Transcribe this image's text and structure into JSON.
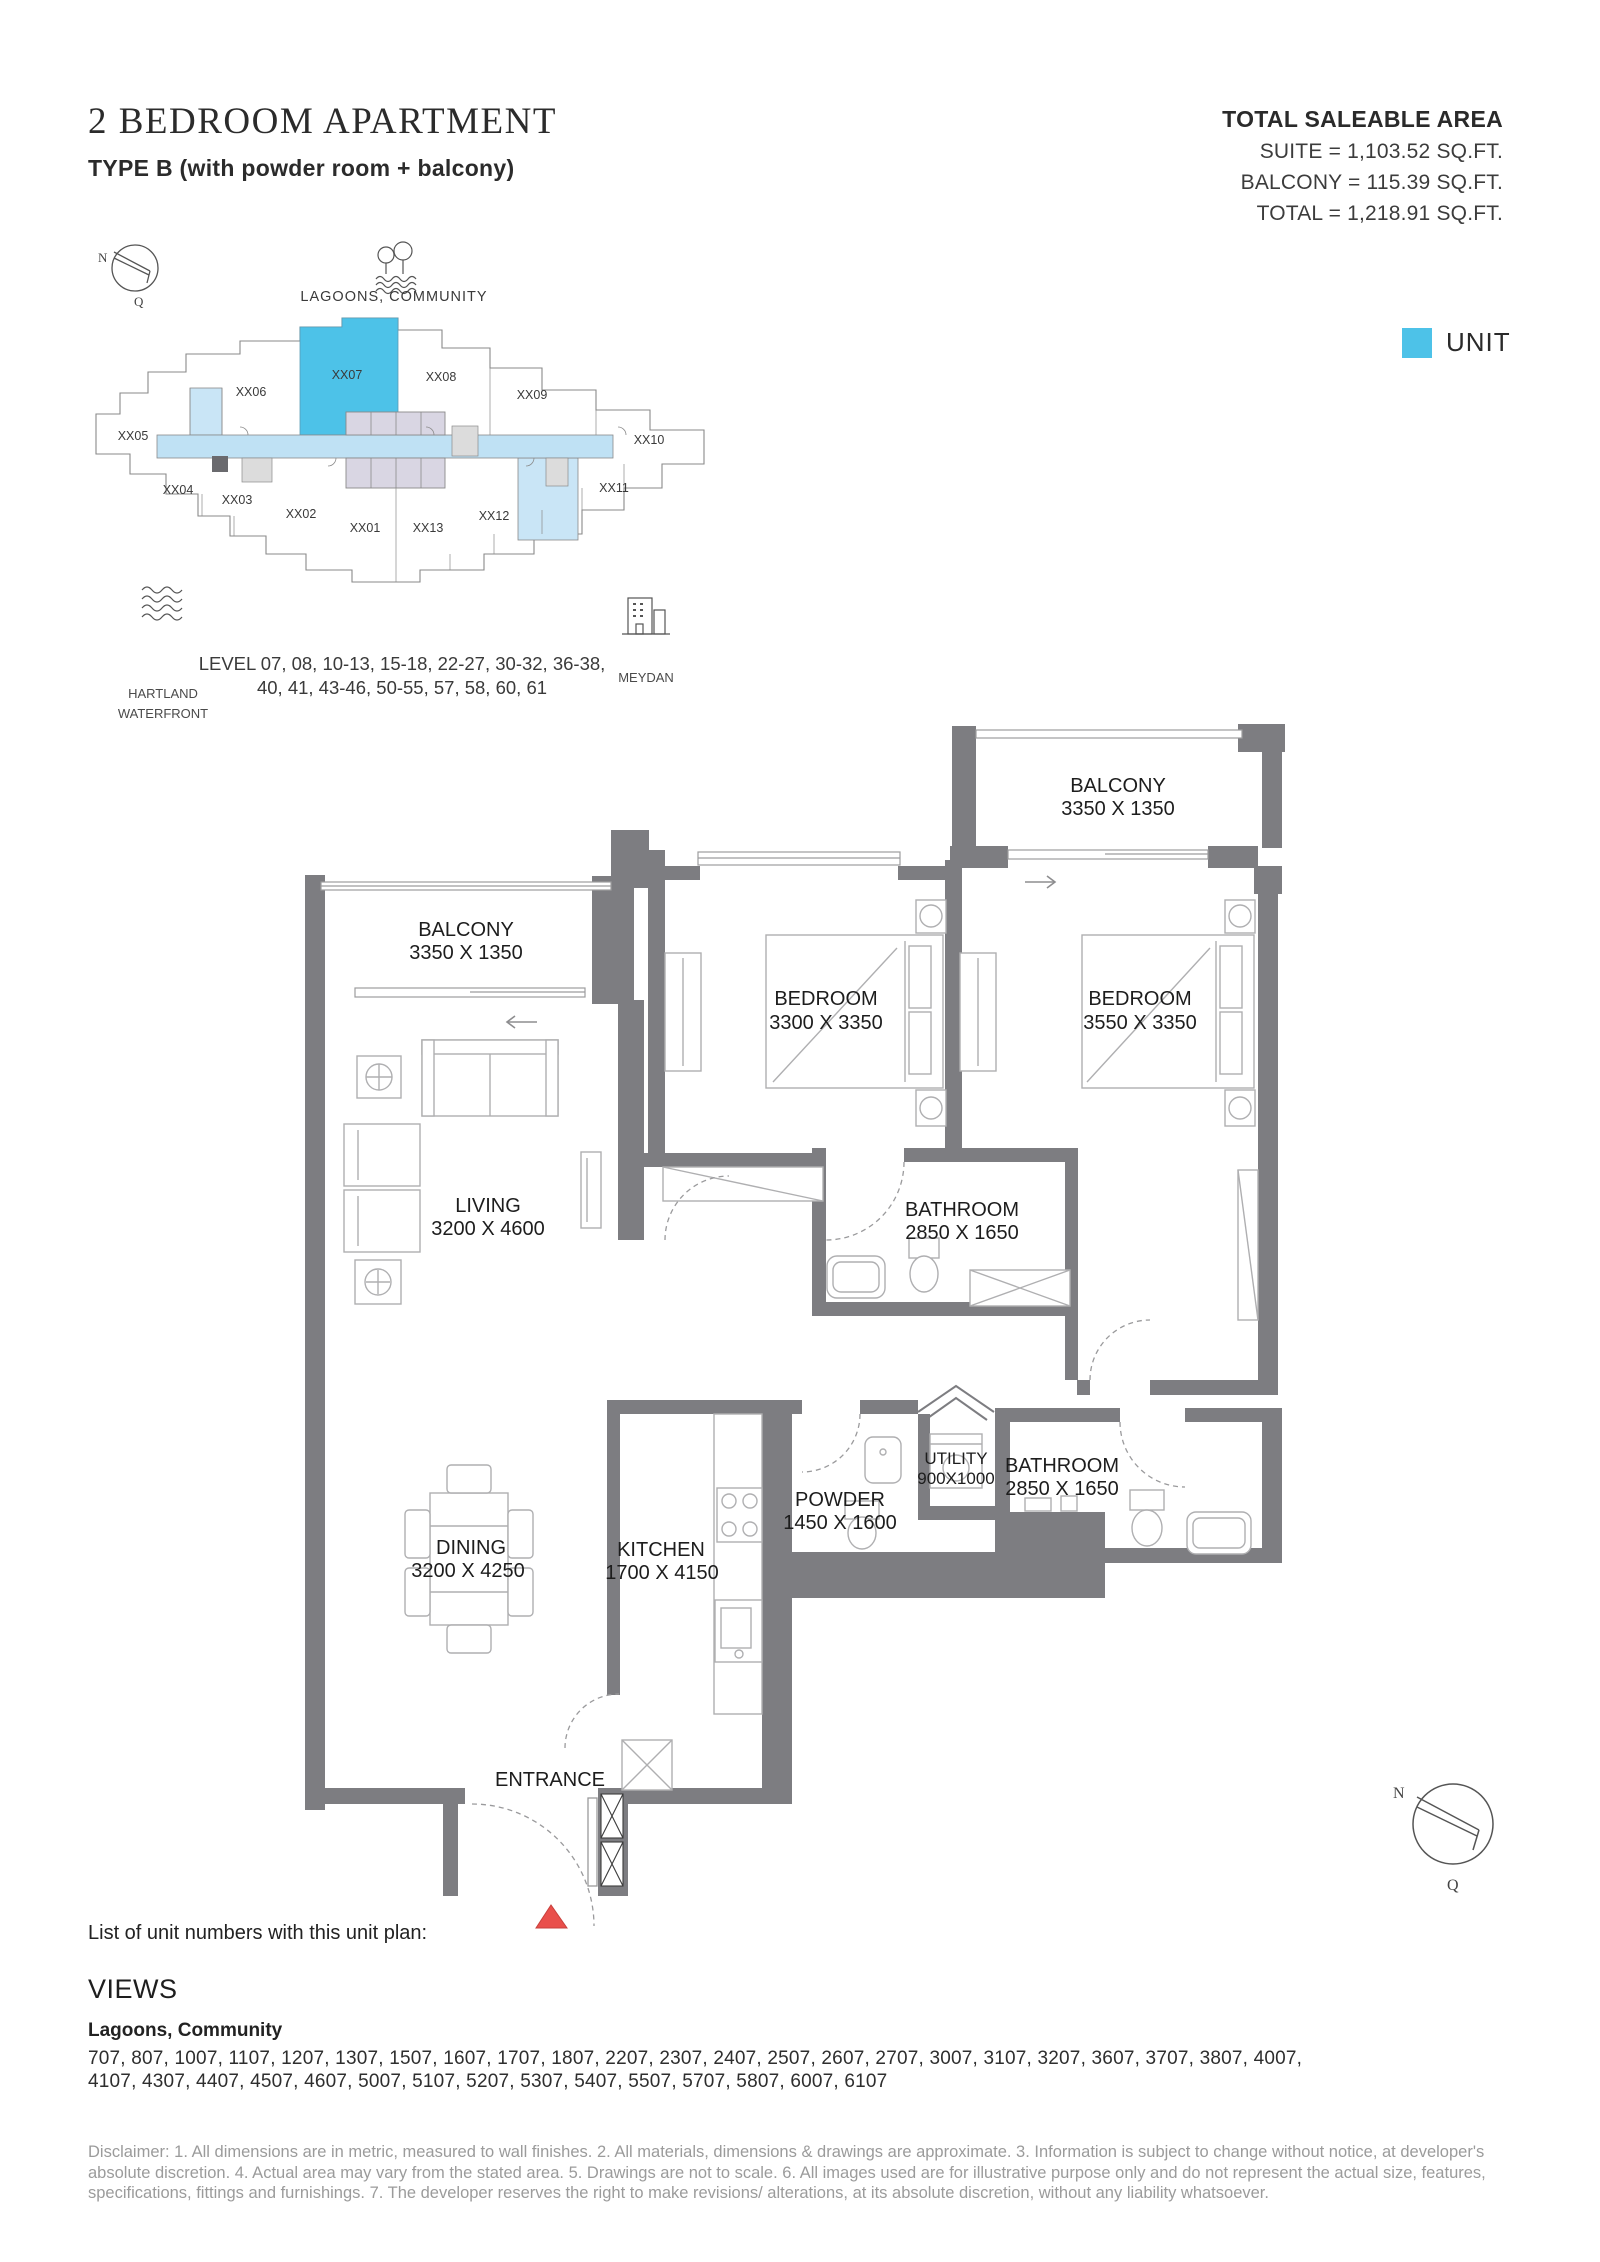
{
  "header": {
    "title": "2 BEDROOM APARTMENT",
    "subtitle": "TYPE B (with powder room + balcony)"
  },
  "saleable_area": {
    "heading": "TOTAL SALEABLE AREA",
    "suite_line": "SUITE = 1,103.52 SQ.FT.",
    "balcony_line": "BALCONY = 115.39 SQ.FT.",
    "total_line": "TOTAL = 1,218.91 SQ.FT."
  },
  "legend": {
    "label": "UNIT",
    "unit_color": "#4DC2E8"
  },
  "key_plan": {
    "compass": {
      "north": "N",
      "south": "Q"
    },
    "lagoons_label": "LAGOONS, COMMUNITY",
    "hartland_label_line1": "HARTLAND",
    "hartland_label_line2": "WATERFRONT",
    "meydan_label": "MEYDAN",
    "units": [
      "XX01",
      "XX02",
      "XX03",
      "XX04",
      "XX05",
      "XX06",
      "XX07",
      "XX08",
      "XX09",
      "XX10",
      "XX11",
      "XX12",
      "XX13"
    ],
    "highlighted_unit": "XX07",
    "level_line1": "LEVEL 07, 08, 10-13, 15-18, 22-27, 30-32, 36-38,",
    "level_line2": "40, 41, 43-46, 50-55, 57, 58, 60, 61"
  },
  "floor_plan": {
    "rooms": {
      "balcony_top": {
        "name": "BALCONY",
        "dims": "3350 X 1350"
      },
      "balcony_left": {
        "name": "BALCONY",
        "dims": "3350 X 1350"
      },
      "bedroom_1": {
        "name": "BEDROOM",
        "dims": "3300 X 3350"
      },
      "bedroom_2": {
        "name": "BEDROOM",
        "dims": "3550 X 3350"
      },
      "living": {
        "name": "LIVING",
        "dims": "3200 X 4600"
      },
      "dining": {
        "name": "DINING",
        "dims": "3200 X 4250"
      },
      "kitchen": {
        "name": "KITCHEN",
        "dims": "1700 X 4150"
      },
      "bathroom_1": {
        "name": "BATHROOM",
        "dims": "2850 X 1650"
      },
      "bathroom_2": {
        "name": "BATHROOM",
        "dims": "2850 X 1650"
      },
      "powder": {
        "name": "POWDER",
        "dims": "1450 X 1600"
      },
      "utility": {
        "name": "UTILITY",
        "dims": "900X1000"
      },
      "entrance": {
        "name": "ENTRANCE"
      }
    }
  },
  "unit_list": {
    "intro": "List of unit numbers with this unit plan:",
    "views_heading": "VIEWS",
    "views_value": "Lagoons, Community",
    "numbers_line1": "707, 807, 1007, 1107, 1207, 1307, 1507, 1607, 1707, 1807, 2207, 2307, 2407, 2507, 2607, 2707, 3007, 3107, 3207, 3607, 3707, 3807, 4007,",
    "numbers_line2": "4107, 4307, 4407, 4507, 4607, 5007, 5107, 5207, 5307, 5407, 5507, 5707, 5807, 6007, 6107"
  },
  "disclaimer": "Disclaimer: 1. All dimensions are in metric, measured to wall finishes. 2. All materials, dimensions & drawings are approximate. 3. Information is subject to change without notice, at developer's absolute discretion. 4. Actual area may vary from the stated area. 5. Drawings are not to scale. 6. All images used are for illustrative purpose only and do not represent the actual size, features, specifications, fittings and furnishings. 7. The developer reserves the right to make revisions/ alterations, at its absolute discretion, without any liability whatsoever.",
  "colors": {
    "wall": "#7D7D81",
    "corridor": "#BFE1F4",
    "light_unit": "#C9E5F6",
    "core": "#D9D6E3",
    "entrance_marker": "#E94F4B"
  },
  "icons": [
    "compass-icon",
    "lagoons-trees-icon",
    "waves-icon",
    "meydan-building-icon",
    "entrance-marker-icon"
  ]
}
